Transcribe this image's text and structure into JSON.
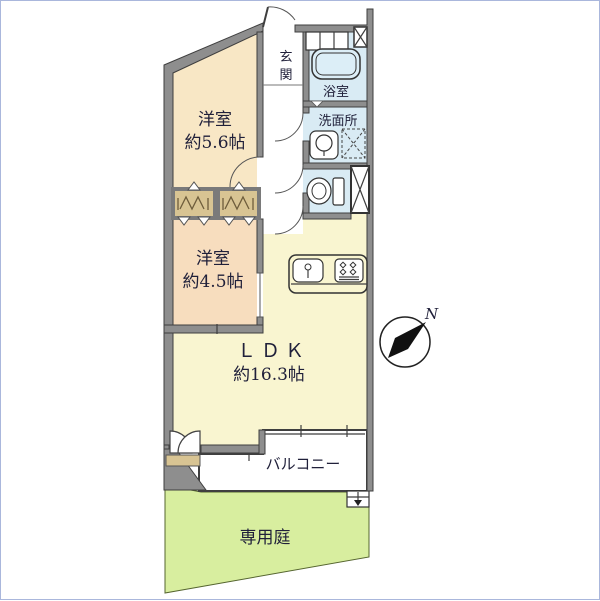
{
  "floorplan": {
    "rooms": {
      "bedroom1": {
        "name": "洋室",
        "size": "約5.6帖"
      },
      "bedroom2": {
        "name": "洋室",
        "size": "約4.5帖"
      },
      "ldk": {
        "name": "ＬＤＫ",
        "size": "約16.3帖"
      },
      "entrance": {
        "char1": "玄",
        "char2": "関"
      },
      "bathroom": {
        "name": "浴室"
      },
      "washroom": {
        "name": "洗面所"
      },
      "balcony": {
        "name": "バルコニー"
      },
      "private_garden": {
        "name": "専用庭"
      }
    },
    "compass": {
      "north": "N"
    },
    "colors": {
      "bedroom1_fill": "#f8e7c5",
      "bedroom2_fill": "#f7ddbe",
      "ldk_fill": "#f9f5d0",
      "wet_fill": "#d9ebf4",
      "closet_fill": "#d8c493",
      "garden_fill": "#d8ee9f",
      "wall_fill": "#8e8e8e",
      "tub_fill": "#dceef7",
      "text": "#20203a"
    }
  }
}
